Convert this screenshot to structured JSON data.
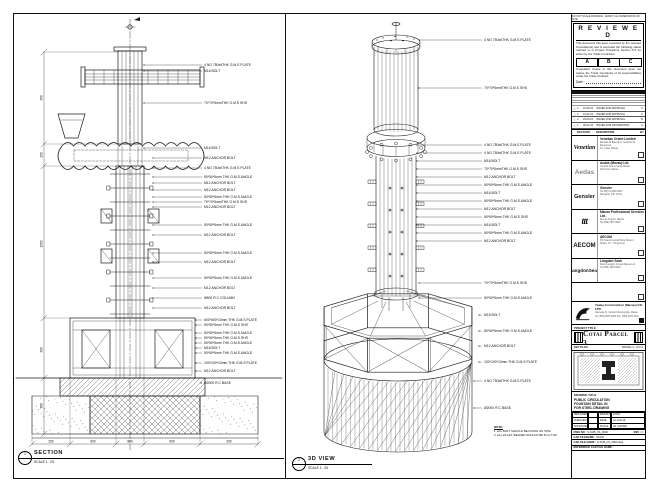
{
  "sheet": {
    "top_note": "DO NOT SCALE DRAWING. VERIFY ALL DIMENSIONS ON SITE."
  },
  "reviewed_stamp": {
    "title": "R E V I E W E D",
    "body1": "This document has been reviewed by the relevant Consultant(s) and is accorded the following status referred to in Project Procedure Section 5.4 for action by the Trade Contractor.",
    "options": [
      "A",
      "B",
      "C"
    ],
    "body2": "Consultant review of this document does not relieve the Trade Contractor of its responsibilities under the Trade Contract.",
    "date_label": "Date :"
  },
  "revision_table": {
    "header": {
      "rev": "REV",
      "date": "DATE",
      "desc": "DESCRIPTION",
      "by": "BY"
    },
    "rows": [
      {
        "rev": "4",
        "date": "21-05-15",
        "desc": "ISSUED FOR APPROVAL",
        "by": "C"
      },
      {
        "rev": "3",
        "date": "14-04-15",
        "desc": "ISSUED FOR APPROVAL",
        "by": "C"
      },
      {
        "rev": "2",
        "date": "26-03-15",
        "desc": "ISSUED FOR APPROVAL",
        "by": "B"
      },
      {
        "rev": "1",
        "date": "08-02-15",
        "desc": "ISSUED FOR INFORMATION",
        "by": "A"
      }
    ]
  },
  "consultants": [
    {
      "logo_text": "Venetian",
      "logo_style": "lg-script",
      "name": "Venetian Orient Limited",
      "lines": [
        "Estrada da Baía de N. Senhora da Esperança",
        "s/n, Taipa, Macau"
      ]
    },
    {
      "logo_text": "Aedas",
      "logo_style": "lg-aedas",
      "name": "Aedas (Macau) Ltd.",
      "lines": [
        "Avenida Comercial de Macau",
        "AIA Tower, Macau"
      ]
    },
    {
      "logo_text": "Gensler",
      "logo_style": "lg-gensler",
      "name": "Gensler",
      "lines": [
        "Tel (86) 21 0000 0000",
        "Shanghai, P.R. China"
      ]
    },
    {
      "logo_text": "ttt",
      "logo_style": "lg-ttt",
      "name": "Macau Professional Services Ltd.",
      "lines": [
        "Rua de Pequim, Macau",
        "Tel (853) 2870 0000"
      ]
    },
    {
      "logo_text": "AECOM",
      "logo_style": "lg-aecom",
      "name": "AECOM",
      "lines": [
        "8/F, Grand Central Plaza Tower 2",
        "Shatin, N.T., Hong Kong"
      ]
    },
    {
      "logo_text": "LangdonSeah",
      "logo_style": "lg-ls",
      "name": "Langdon Seah",
      "lines": [
        "Davis Langdon & Seah Macau Ltd.",
        "Tel (853) 2833 0000"
      ]
    }
  ],
  "contractor": {
    "name": "Yadea Construction (Macau) CO. LTD.",
    "lines": [
      "Alameda Dr. Carlos D'Assumpção, Macau",
      "Tel: (853) 2875 0000  Fax: (853) 2875 0001"
    ]
  },
  "project": {
    "label": "PROJECT TITLE",
    "title": "Cotai Parcel 3"
  },
  "key_plan": {
    "label": "KEY PLAN",
    "zone": "PARCEL 3 - LOT A"
  },
  "title_block": {
    "drawing_title_label": "DRAWING TITLE:",
    "drawing_title": [
      "PUBLIC CIRCULATION",
      "FOUNTAIN DETAIL IN",
      "FOR STEEL DRAWING"
    ],
    "fields": {
      "designed_label": "DESIGNED",
      "designed": "",
      "drawn_label": "DRAWN",
      "drawn": "LUNG",
      "checked_label": "CHECKED",
      "checked": "-",
      "date_label": "DATE",
      "date": "14-JUN-15",
      "approved_label": "APPROVED",
      "approved": "-",
      "scale_label": "SCALE",
      "scale": "AS SHOWN"
    },
    "dwg_no_label": "DWG NO :",
    "dwg_no": "S-SUB_FS_0000",
    "rev_label": "REV :",
    "rev": "C",
    "cad_label": "CAD FILENAME :",
    "cad": "S1504",
    "cad_file_label": "CAD FILE NAME :",
    "cad_file": "S-SUB_FS_0000.dwg",
    "ref_label": "REFERENCE CAD FILE NAME :"
  },
  "section_view": {
    "bubble_top": "1",
    "bubble_bottom": "-",
    "label": "SECTION",
    "scale": "SCALE 1 : 25",
    "dims_left": [
      "450",
      "150",
      "1050",
      "400",
      "380"
    ],
    "dims_bottom": [
      "250",
      "600",
      "800",
      "600",
      "250"
    ],
    "callouts": [
      {
        "y": 51,
        "text": "4 NO 750x6THK G.M.S PLATE"
      },
      {
        "y": 57,
        "text": "M16 BOLT"
      },
      {
        "y": 89,
        "text": "70*70*5mmTHK G.M.S SHS"
      },
      {
        "y": 134,
        "text": "M16 BOLT"
      },
      {
        "y": 144,
        "text": "M12 ANCHOR BOLT"
      },
      {
        "y": 154,
        "text": "4 NO 750x6THK G.M.S PLATE"
      },
      {
        "y": 163,
        "text": "50*50*5mm THK G.M.S ANGLE"
      },
      {
        "y": 169,
        "text": "M12 ANCHOR BOLT"
      },
      {
        "y": 176,
        "text": "M12 ANCHOR BOLT"
      },
      {
        "y": 183,
        "text": "50*50*5mm THK G.M.S ANGLE"
      },
      {
        "y": 188,
        "text": "70*70*5mmTHK G.M.S SHS"
      },
      {
        "y": 193,
        "text": "M12 ANCHOR BOLT"
      },
      {
        "y": 211,
        "text": "50*50*5mm THK G.M.S ANGLE"
      },
      {
        "y": 221,
        "text": "M12 ANCHOR BOLT"
      },
      {
        "y": 239,
        "text": "50*50*5mm THK G.M.S ANGLE"
      },
      {
        "y": 248,
        "text": "M12 ANCHOR BOLT"
      },
      {
        "y": 264,
        "text": "50*50*5mm THK G.M.S ANGLE"
      },
      {
        "y": 274,
        "text": "M12 ANCHOR BOLT"
      },
      {
        "y": 284,
        "text": "Ø600 R.C COLUMN"
      },
      {
        "y": 294,
        "text": "M12 ANCHOR BOLT"
      },
      {
        "y": 306,
        "text": "600*600*10mm THK G.M.S PLATE"
      },
      {
        "y": 311,
        "text": "50*50*5mm THK G.M.S SHS"
      },
      {
        "y": 319,
        "text": "50*50*5mm THK G.M.S ANGLE"
      },
      {
        "y": 324,
        "text": "50*50*5mm THK G.M.S SHS"
      },
      {
        "y": 329,
        "text": "50*50*5mm THK G.M.S ANGLE"
      },
      {
        "y": 334,
        "text": "M16 BOLT"
      },
      {
        "y": 339,
        "text": "50*50*5mm THK G.M.S ANGLE"
      },
      {
        "y": 349,
        "text": "100*100*10mm THK G.M.S PLATE"
      },
      {
        "y": 357,
        "text": "M12 ANCHOR BOLT"
      },
      {
        "y": 369,
        "text": "Ø2000 R.C BASE"
      }
    ]
  },
  "iso_view": {
    "bubble_top": "2",
    "bubble_bottom": "-",
    "label": "3D VIEW",
    "scale": "SCALE 1 : 25",
    "callouts": [
      {
        "y": 26,
        "text": "4 NO 750x6THK G.M.S PLATE"
      },
      {
        "y": 74,
        "text": "70*70*5mmTHK G.M.S SHS"
      },
      {
        "y": 131,
        "text": "4 NO 750x6THK G.M.S PLATE"
      },
      {
        "y": 139,
        "text": "4 NO 750x6THK G.M.S PLATE"
      },
      {
        "y": 147,
        "text": "M16 BOLT"
      },
      {
        "y": 155,
        "text": "70*70*5mmTHK G.M.S SHS"
      },
      {
        "y": 163,
        "text": "M12 ANCHOR BOLT"
      },
      {
        "y": 171,
        "text": "50*50*5mm THK G.M.S ANGLE"
      },
      {
        "y": 179,
        "text": "M16 BOLT"
      },
      {
        "y": 187,
        "text": "50*50*5mm THK G.M.S ANGLE"
      },
      {
        "y": 195,
        "text": "M12 ANCHOR BOLT"
      },
      {
        "y": 203,
        "text": "50*50*5mm THK G.M.S SHS"
      },
      {
        "y": 211,
        "text": "M16 BOLT"
      },
      {
        "y": 219,
        "text": "50*50*5mm THK G.M.S ANGLE"
      },
      {
        "y": 227,
        "text": "M12 ANCHOR BOLT"
      },
      {
        "y": 269,
        "text": "70*70*5mmTHK G.M.S SHS"
      },
      {
        "y": 284,
        "text": "50*50*5mm THK G.M.S ANGLE"
      },
      {
        "y": 301,
        "text": "M16 BOLT"
      },
      {
        "y": 317,
        "text": "50*50*5mm THK G.M.S ANGLE"
      },
      {
        "y": 332,
        "text": "M12 ANCHOR BOLT"
      },
      {
        "y": 348,
        "text": "100*100*10mm THK G.M.S PLATE"
      },
      {
        "y": 367,
        "text": "4 NO 750x6THK G.M.S PLATE"
      },
      {
        "y": 394,
        "text": "Ø2000 R.C BASE"
      }
    ]
  },
  "notes": {
    "title": "NOTE:",
    "items": [
      "1. ALL BOLT SHOULD BE FIXING ON SITE.",
      "2. ALL FILLET WELDED SHOULD BE 6mm THK."
    ]
  }
}
